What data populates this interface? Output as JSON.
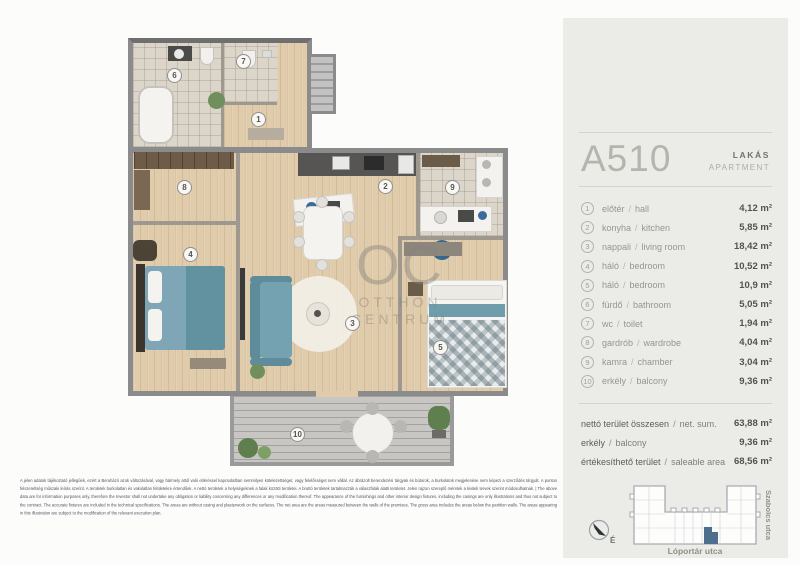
{
  "header": {
    "code": "A510",
    "type_hu": "LAKÁS",
    "type_en": "APARTMENT"
  },
  "ui": {
    "separator": "/"
  },
  "rooms": [
    {
      "num": "1",
      "name_hu": "előtér",
      "name_en": "hall",
      "area": "4,12 m²"
    },
    {
      "num": "2",
      "name_hu": "konyha",
      "name_en": "kitchen",
      "area": "5,85 m²"
    },
    {
      "num": "3",
      "name_hu": "nappali",
      "name_en": "living room",
      "area": "18,42 m²"
    },
    {
      "num": "4",
      "name_hu": "háló",
      "name_en": "bedroom",
      "area": "10,52 m²"
    },
    {
      "num": "5",
      "name_hu": "háló",
      "name_en": "bedroom",
      "area": "10,9 m²"
    },
    {
      "num": "6",
      "name_hu": "fürdő",
      "name_en": "bathroom",
      "area": "5,05 m²"
    },
    {
      "num": "7",
      "name_hu": "wc",
      "name_en": "toilet",
      "area": "1,94 m²"
    },
    {
      "num": "8",
      "name_hu": "gardrób",
      "name_en": "wardrobe",
      "area": "4,04 m²"
    },
    {
      "num": "9",
      "name_hu": "kamra",
      "name_en": "chamber",
      "area": "3,04 m²"
    },
    {
      "num": "10",
      "name_hu": "erkély",
      "name_en": "balcony",
      "area": "9,36 m²"
    }
  ],
  "summary": [
    {
      "label_hu": "nettó terület összesen",
      "label_en": "net. sum.",
      "value": "63,88 m²"
    },
    {
      "label_hu": "erkély",
      "label_en": "balcony",
      "value": "9,36 m²"
    },
    {
      "label_hu": "értékesíthető terület",
      "label_en": "saleable area",
      "value": "68,56 m²"
    }
  ],
  "watermark": {
    "monogram": "OC",
    "line1": "OTTHON",
    "line2": "CENTRUM"
  },
  "map": {
    "street_right": "Szabolcs utca",
    "street_bottom": "Lóportár utca",
    "north_label": "É"
  },
  "disclaimer": "A jelen adatok tájékoztató jellegűek, ezért a Beruházó azok változásával, vagy bármely attól való eltéréssel kapcsolatban semmilyen kötelezettséget, vagy felelősséget nem vállal. Az ábrázolt berendezési tárgyak és bútorok, a burkolatok megjelenése nem képezi a szerződés tárgyát. A pontos felszereltség műszaki leírás szerint. A területek burkolatlan és vakolatlan felületekre értendőek. A nettó területek a helyiségeknek a falak közötti területei. A bruttó területek tartalmazzák a válaszfalak alatti területet. Jelen rajzon szereplő méretek a kiviteli tervek szerint módosulhatnak. | The above data are for information purposes only, therefore the Investor shall not undertake any obligation or liability concerning any differences or any modification thereof. The appearance of the furnishings and other interior design fixtures, including the casings are only illustrations and thus not subject to the contract. The accurate fixtures are included in the technical specifications. The areas are without casing and plasterwork on the surfaces. The net area are the areas measured between the walls of the premises. The gross area includes the areas below the partition walls. The areas appearing in this illustration are subject to the modification of the relevant execution plan."
}
